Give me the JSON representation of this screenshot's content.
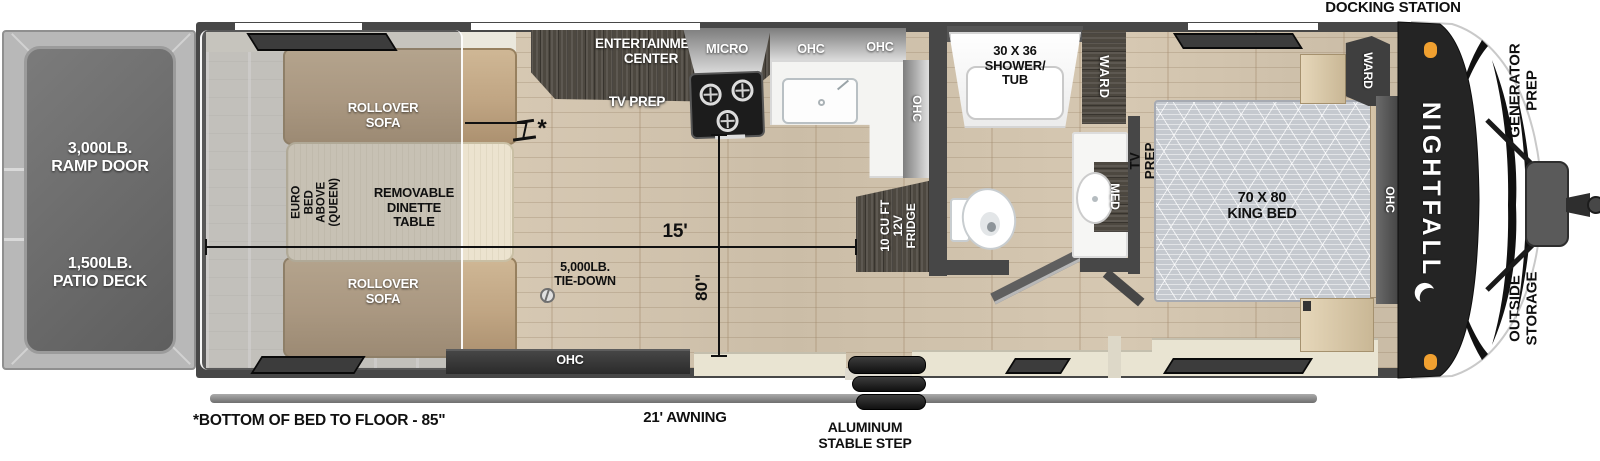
{
  "title": {
    "docking_station": "DOCKING STATION"
  },
  "colors": {
    "wall": "#474747",
    "wood_floor": "#d3c5af",
    "garage_floor": "#e4e1da",
    "sofa_tan": "#c0a583",
    "bench_cream": "#e9e4d2",
    "cabinet_dark_wood": "#4d4840",
    "marker_orange": "#f0a030",
    "front_cap": "#242424"
  },
  "rear": {
    "ramp_door": "3,000LB.\nRAMP DOOR",
    "patio_deck": "1,500LB.\nPATIO DECK"
  },
  "garage": {
    "rollover_sofa": "ROLLOVER\nSOFA",
    "euro_bed": "EURO BED\nABOVE\n(QUEEN)",
    "dinette": "REMOVABLE\nDINETTE\nTABLE",
    "tie_down": "5,000LB.\nTIE-DOWN",
    "ohc": "OHC",
    "marker": "*"
  },
  "living": {
    "entertainment_center": "ENTERTAINMENT\nCENTER",
    "tv_prep": "TV PREP"
  },
  "kitchen": {
    "micro": "MICRO",
    "ohc": "OHC",
    "fridge": "10 CU FT\n12V\nFRIDGE"
  },
  "bath": {
    "shower": "30 X 36\nSHOWER/\nTUB",
    "ward": "WARD",
    "med": "MED"
  },
  "bedroom": {
    "bed": "70 X 80\nKING BED",
    "tv_prep": "TV PREP",
    "ward": "WARD",
    "ohc": "OHC"
  },
  "dims": {
    "length": "15'",
    "height": "80\""
  },
  "exterior": {
    "brand": "NIGHTFALL",
    "generator_prep": "GENERATOR\nPREP",
    "outside_storage": "OUTSIDE\nSTORAGE",
    "awning": "21' AWNING",
    "step": "ALUMINUM\nSTABLE STEP",
    "footnote": "*BOTTOM OF BED TO FLOOR - 85\""
  }
}
